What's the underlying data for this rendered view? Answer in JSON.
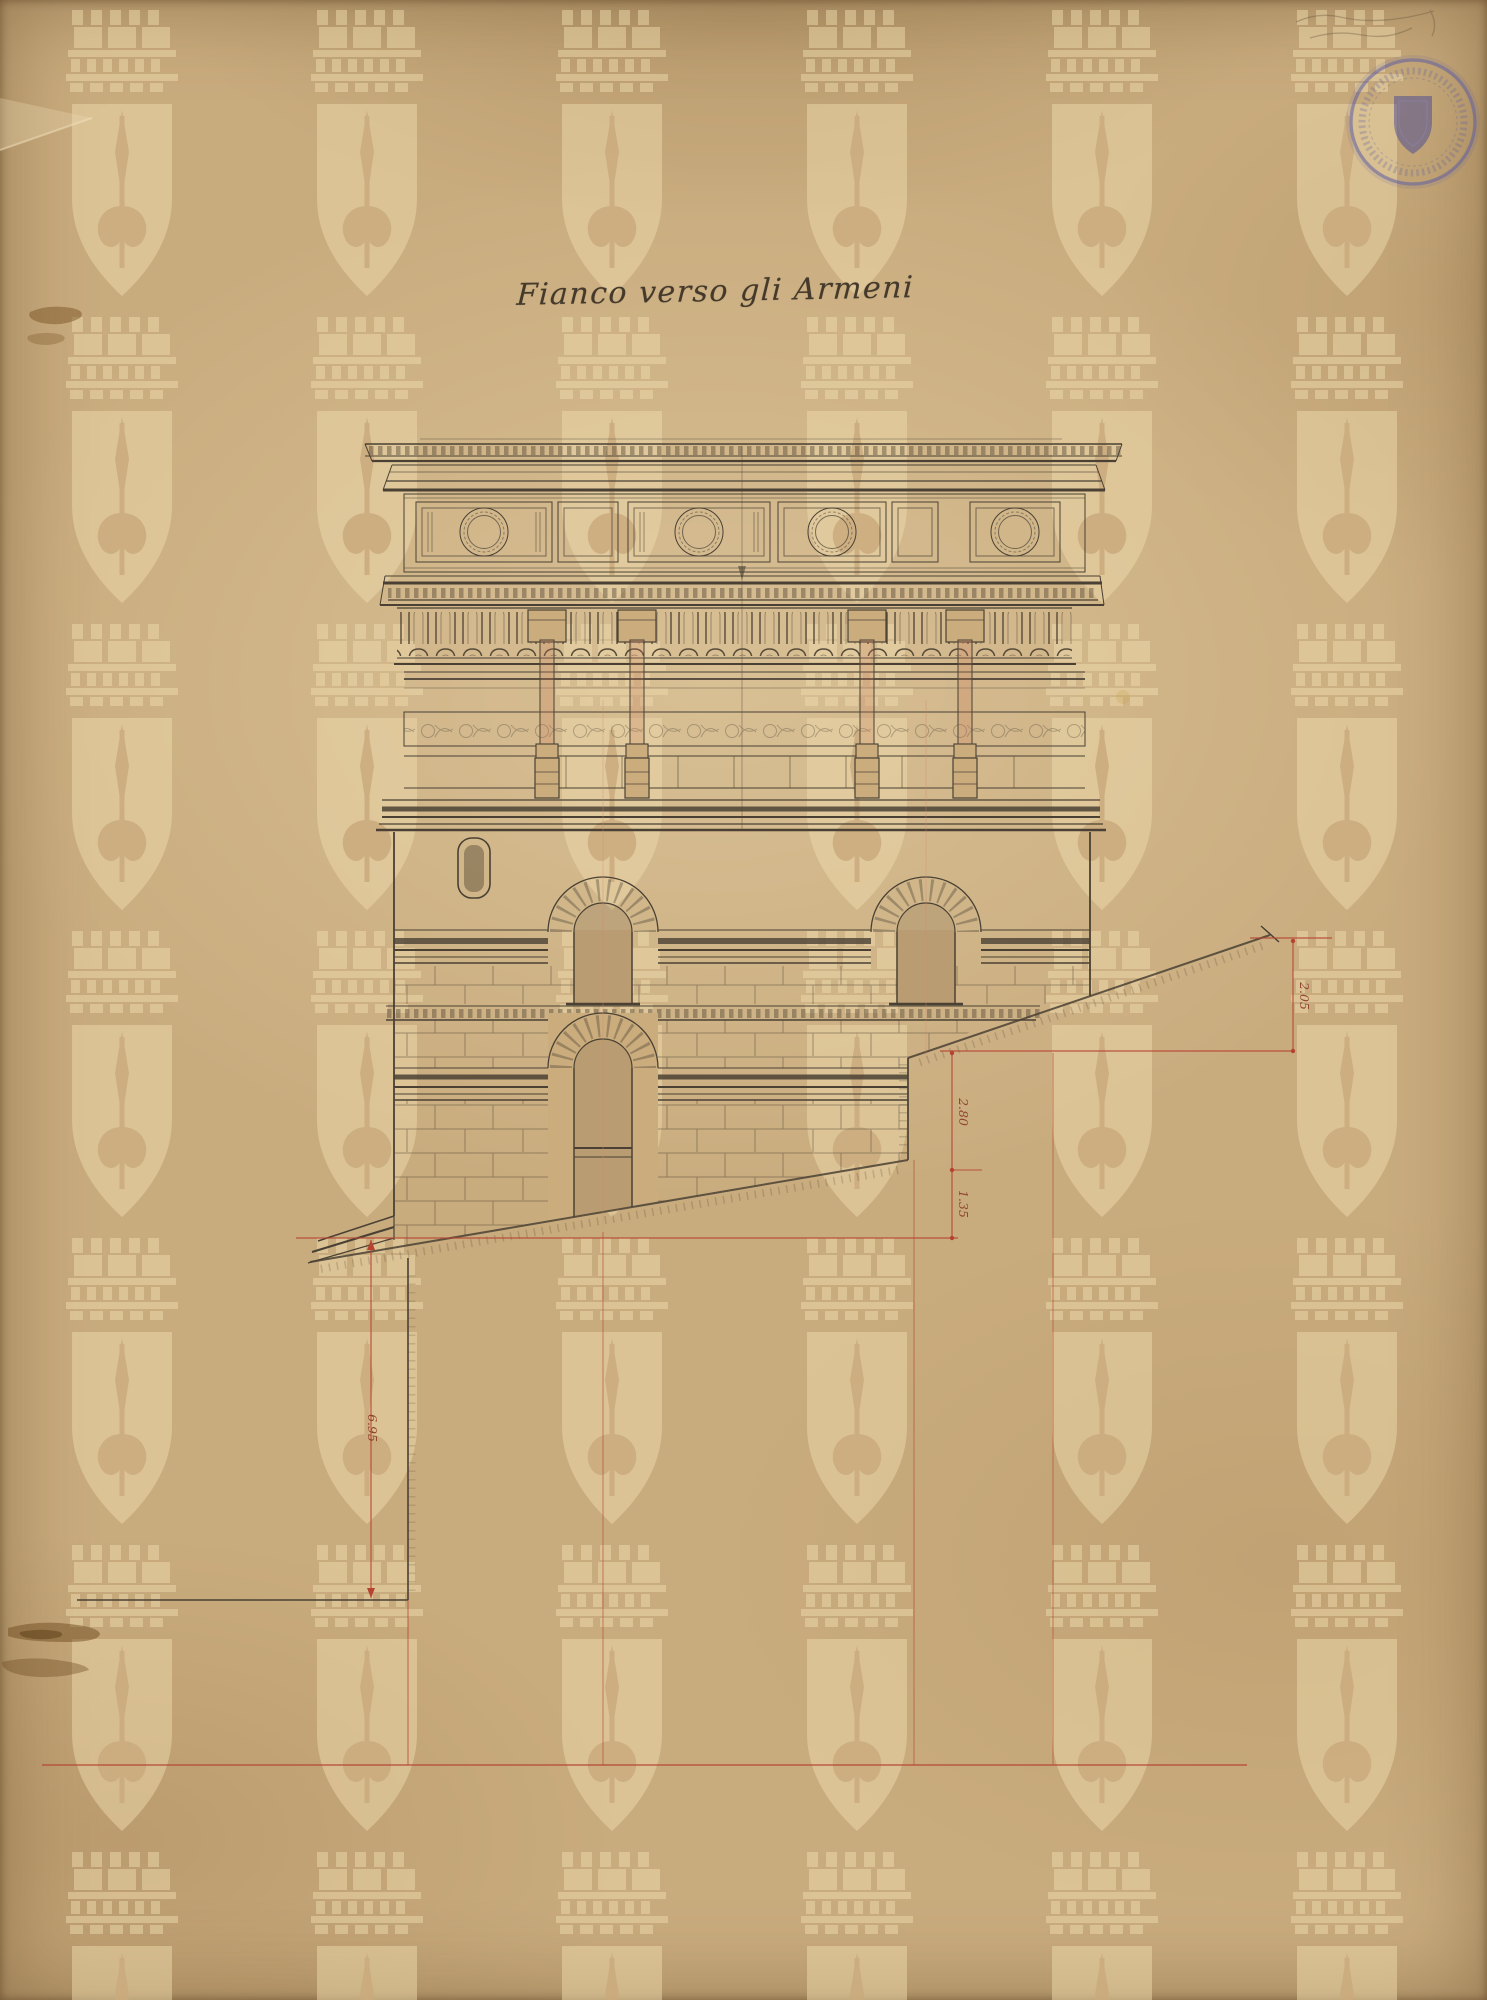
{
  "document": {
    "type": "scanned archival architectural drawing, building side elevation",
    "title": "Fianco verso gli Armeni",
    "title_style": "handwritten ink script"
  },
  "dimension_labels": {
    "right_upper": "2.05",
    "middle_upper": "2.80",
    "middle_lower": "1.35",
    "left": "6.95"
  },
  "stamp": {
    "shape": "circular",
    "motif": "heraldic-shield",
    "ink_color": "#5d5da3",
    "rim_text_legible": false
  },
  "watermark": {
    "motif": "mural crown above shield with halberd",
    "arrangement": "repeating grid",
    "color": "#eddaab"
  },
  "annotations": {
    "pencil_note_top_right": "illegible pencil scribble"
  },
  "colors": {
    "paper": "#c9ac7e",
    "ink": "#4a4134",
    "red_ink": "#b5432f",
    "stamp_blue": "#5d5da3"
  }
}
